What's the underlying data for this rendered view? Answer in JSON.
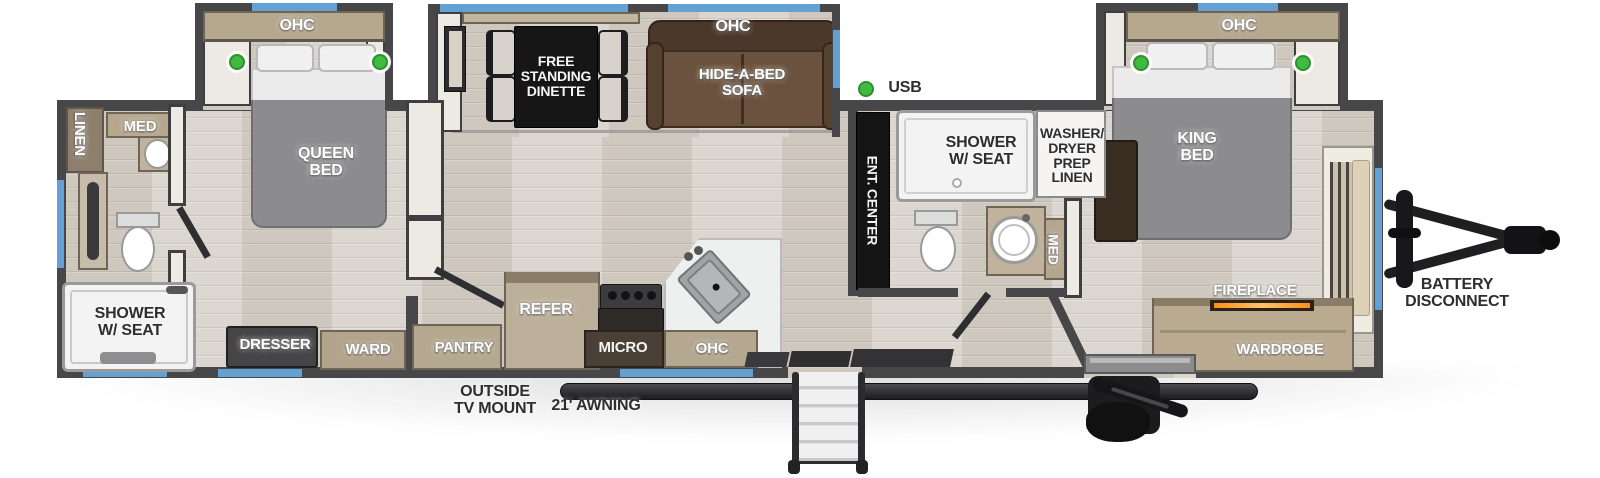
{
  "diagram_type": "rv-travel-trailer-floorplan",
  "colors": {
    "wall": "#47474a",
    "floor_wood": "#d6d1c9",
    "window_blue": "#64a0d2",
    "led_green": "#3fbb3f",
    "bed_gray": "#8c8c8f",
    "sofa_brown": "#6a523e",
    "cabinet_tan": "#b6a88f",
    "table_black": "#161616",
    "fire_orange": "#ff9a2e",
    "fixture_white": "#f3f3f3"
  },
  "labels": [
    {
      "id": "ohc-queen",
      "text": "OHC",
      "left": 267,
      "top": 18,
      "width": 60,
      "size": 16,
      "style": "light",
      "vert": false
    },
    {
      "id": "linen",
      "text": "LINEN",
      "left": 49,
      "top": 126,
      "width": 60,
      "size": 15,
      "style": "light",
      "vert": true
    },
    {
      "id": "med-rear",
      "text": "MED",
      "left": 115,
      "top": 119,
      "width": 50,
      "size": 15,
      "style": "light",
      "vert": false
    },
    {
      "id": "queen-bed",
      "text": "QUEEN\nBED",
      "left": 286,
      "top": 146,
      "width": 80,
      "size": 16,
      "style": "light",
      "vert": false
    },
    {
      "id": "shower-rear",
      "text": "SHOWER\nW/ SEAT",
      "left": 85,
      "top": 306,
      "width": 90,
      "size": 16,
      "style": "dark",
      "vert": false
    },
    {
      "id": "dresser",
      "text": "DRESSER",
      "left": 230,
      "top": 337,
      "width": 90,
      "size": 15,
      "style": "light",
      "vert": false
    },
    {
      "id": "ward",
      "text": "WARD",
      "left": 333,
      "top": 342,
      "width": 70,
      "size": 15,
      "style": "light",
      "vert": false
    },
    {
      "id": "free-standing-dinette",
      "text": "FREE\nSTANDING\nDINETTE",
      "left": 511,
      "top": 54,
      "width": 90,
      "size": 14,
      "style": "onblack",
      "vert": false
    },
    {
      "id": "ohc-sofa",
      "text": "OHC",
      "left": 703,
      "top": 19,
      "width": 60,
      "size": 16,
      "style": "light",
      "vert": false
    },
    {
      "id": "hide-a-bed-sofa",
      "text": "HIDE-A-BED\nSOFA",
      "left": 682,
      "top": 67,
      "width": 120,
      "size": 15,
      "style": "light",
      "vert": false
    },
    {
      "id": "usb",
      "text": "USB",
      "left": 883,
      "top": 80,
      "width": 44,
      "size": 16,
      "style": "dark",
      "vert": false
    },
    {
      "id": "ent-center",
      "text": "ENT. CENTER",
      "left": 817,
      "top": 193,
      "width": 110,
      "size": 14,
      "style": "onblack",
      "vert": true
    },
    {
      "id": "shower-mid",
      "text": "SHOWER\nW/ SEAT",
      "left": 936,
      "top": 135,
      "width": 90,
      "size": 16,
      "style": "dark",
      "vert": false
    },
    {
      "id": "washer-dryer-prep",
      "text": "WASHER/\nDRYER\nPREP\nLINEN",
      "left": 1032,
      "top": 126,
      "width": 80,
      "size": 14,
      "style": "dark",
      "vert": false
    },
    {
      "id": "med-mid",
      "text": "MED",
      "left": 1031,
      "top": 242,
      "width": 44,
      "size": 14,
      "style": "light",
      "vert": true
    },
    {
      "id": "king-bed",
      "text": "KING\nBED",
      "left": 1162,
      "top": 131,
      "width": 70,
      "size": 16,
      "style": "light",
      "vert": false
    },
    {
      "id": "ohc-king",
      "text": "OHC",
      "left": 1209,
      "top": 18,
      "width": 60,
      "size": 16,
      "style": "light",
      "vert": false
    },
    {
      "id": "pantry",
      "text": "PANTRY",
      "left": 424,
      "top": 340,
      "width": 80,
      "size": 15,
      "style": "light",
      "vert": false
    },
    {
      "id": "refer",
      "text": "REFER",
      "left": 511,
      "top": 302,
      "width": 70,
      "size": 16,
      "style": "light",
      "vert": false
    },
    {
      "id": "micro",
      "text": "MICRO",
      "left": 588,
      "top": 340,
      "width": 70,
      "size": 15,
      "style": "onblack",
      "vert": false
    },
    {
      "id": "ohc-kitchen",
      "text": "OHC",
      "left": 682,
      "top": 341,
      "width": 60,
      "size": 15,
      "style": "light",
      "vert": false
    },
    {
      "id": "outside-tv-mount",
      "text": "OUTSIDE\nTV MOUNT",
      "left": 440,
      "top": 384,
      "width": 110,
      "size": 16,
      "style": "dark",
      "vert": false
    },
    {
      "id": "awning",
      "text": "21' AWNING",
      "left": 536,
      "top": 398,
      "width": 120,
      "size": 16,
      "style": "dark",
      "vert": false
    },
    {
      "id": "fireplace",
      "text": "FIREPLACE",
      "left": 1205,
      "top": 283,
      "width": 100,
      "size": 15,
      "style": "light",
      "vert": false
    },
    {
      "id": "wardrobe",
      "text": "WARDROBE",
      "left": 1225,
      "top": 342,
      "width": 110,
      "size": 15,
      "style": "light",
      "vert": false
    },
    {
      "id": "battery-disconnect",
      "text": "BATTERY\nDISCONNECT",
      "left": 1392,
      "top": 277,
      "width": 130,
      "size": 16,
      "style": "dark",
      "vert": false
    }
  ]
}
